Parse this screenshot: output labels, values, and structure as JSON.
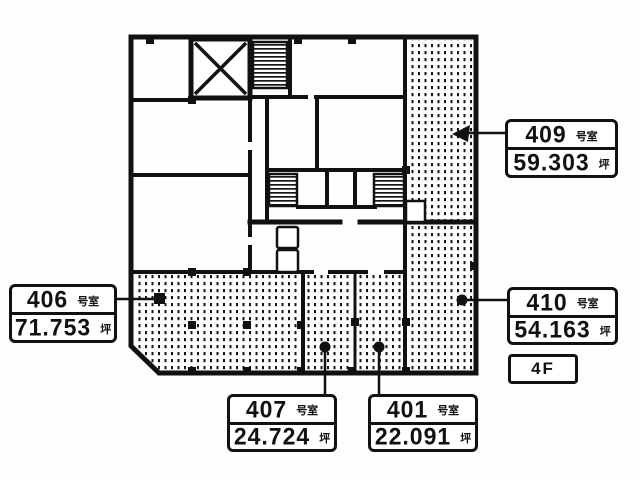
{
  "floor_label": "4F",
  "rooms": [
    {
      "number": "409",
      "number_suffix": "号室",
      "area": "59.303",
      "area_unit": "坪"
    },
    {
      "number": "410",
      "number_suffix": "号室",
      "area": "54.163",
      "area_unit": "坪"
    },
    {
      "number": "406",
      "number_suffix": "号室",
      "area": "71.753",
      "area_unit": "坪"
    },
    {
      "number": "407",
      "number_suffix": "号室",
      "area": "24.724",
      "area_unit": "坪"
    },
    {
      "number": "401",
      "number_suffix": "号室",
      "area": "22.091",
      "area_unit": "坪"
    }
  ]
}
